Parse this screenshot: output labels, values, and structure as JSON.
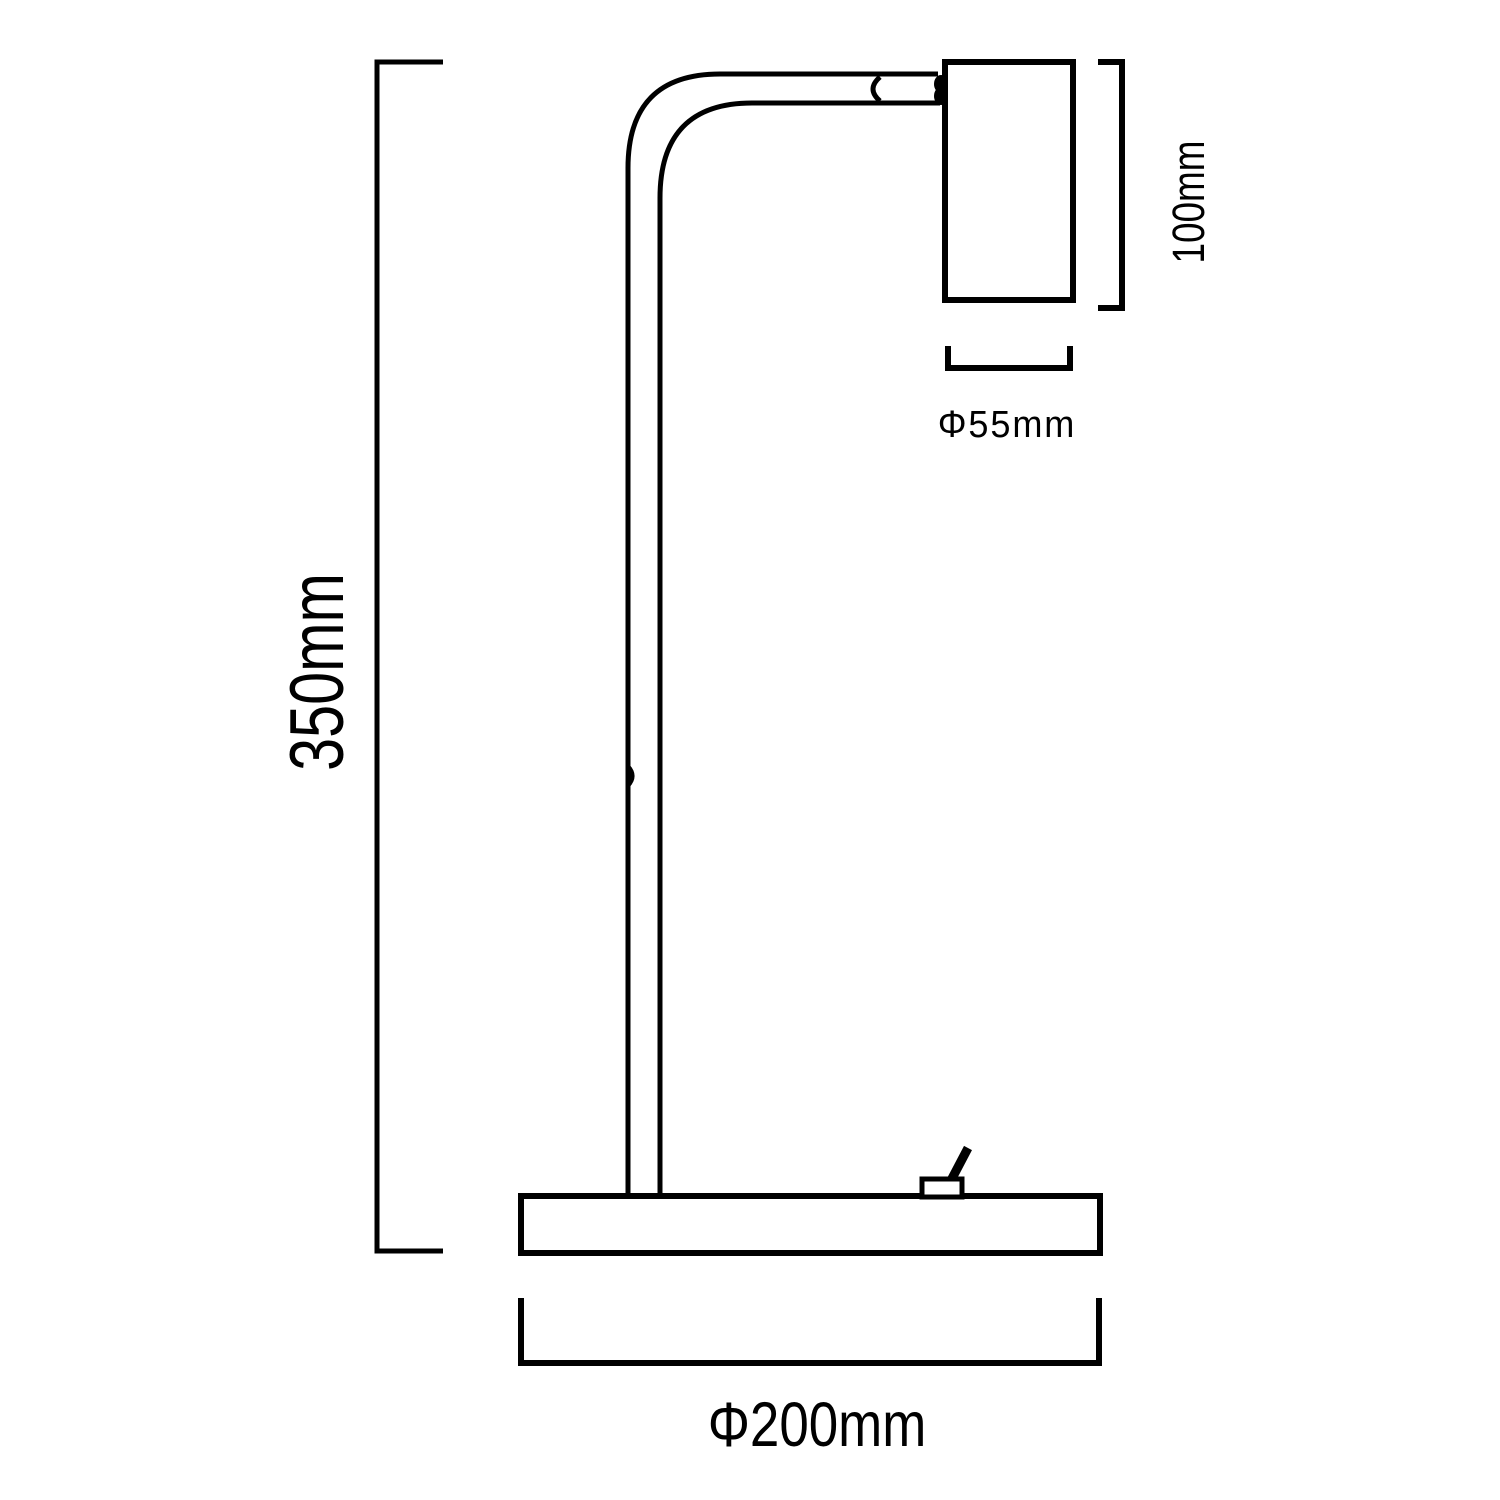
{
  "diagram": {
    "kind": "technical-dimension-drawing",
    "colors": {
      "line": "#000000",
      "background": "#ffffff"
    },
    "labels": {
      "overall_height": "350mm",
      "head_height": "100mm",
      "head_diameter": "Φ55mm",
      "base_diameter": "Φ200mm"
    }
  }
}
